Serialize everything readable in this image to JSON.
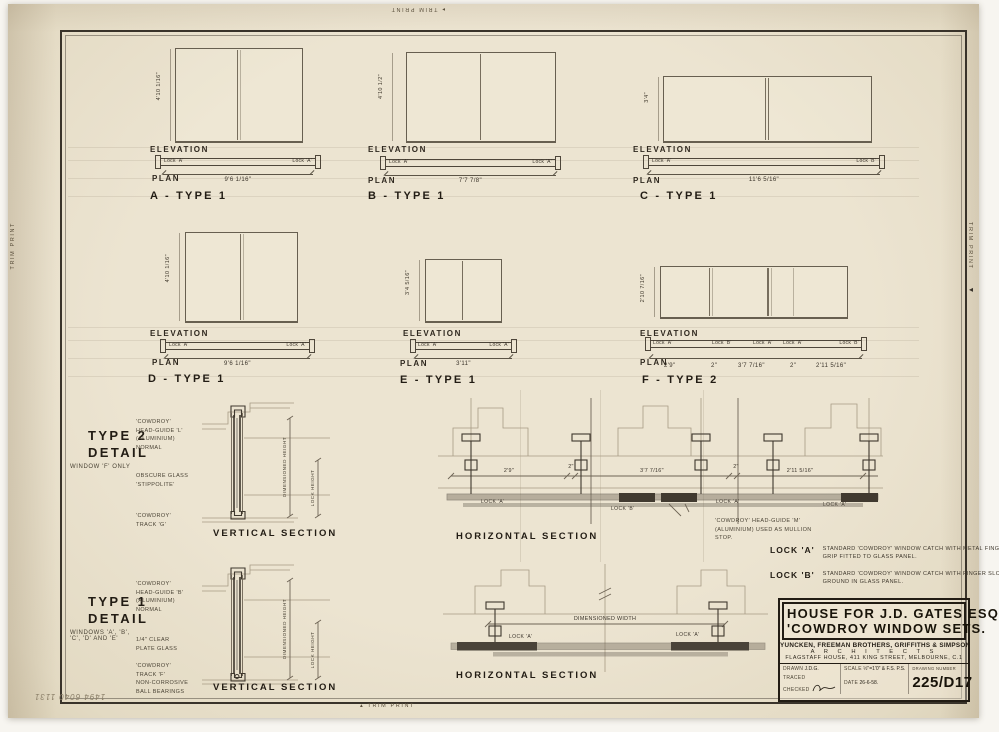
{
  "page": {
    "trim_print": "TRIM PRINT",
    "handwritten_note": "1494 6040 1131"
  },
  "labels": {
    "elevation": "ELEVATION",
    "plan": "PLAN"
  },
  "windows": [
    {
      "letter": "A",
      "title": "A - TYPE 1",
      "height": "4'10 1/16\"",
      "width": "9'6 1/16\"",
      "lock_left": "Lock 'A'",
      "lock_right": "Lock 'A'"
    },
    {
      "letter": "B",
      "title": "B - TYPE 1",
      "height": "4'10 1/2\"",
      "width": "7'7 7/8\"",
      "lock_left": "Lock 'A'",
      "lock_right": "Lock 'A'"
    },
    {
      "letter": "C",
      "title": "C - TYPE 1",
      "height": "3'4\"",
      "width": "11'6 5/16\"",
      "lock_left": "Lock 'A'",
      "lock_right": "Lock 'B'"
    },
    {
      "letter": "D",
      "title": "D - TYPE 1",
      "height": "4'10 1/16\"",
      "width": "9'6 1/16\"",
      "lock_left": "Lock 'A'",
      "lock_right": "Lock 'A'"
    },
    {
      "letter": "E",
      "title": "E - TYPE 1",
      "height": "3'4 5/16\"",
      "width": "3'11\"",
      "lock_left": "Lock 'A'",
      "lock_right": "Lock 'A'"
    },
    {
      "letter": "F",
      "title": "F - TYPE 2",
      "height": "2'10 7/16\"",
      "plan_locks": [
        "Lock 'A'",
        "Lock 'B'",
        "Lock 'A'",
        "Lock 'A'",
        "Lock 'B'"
      ],
      "plan_dims": [
        "2'9\"",
        "2\"",
        "3'7 7/16\"",
        "2\"",
        "2'11 5/16\""
      ]
    }
  ],
  "type2_detail": {
    "heading": "TYPE 2\nDETAIL",
    "subtitle": "WINDOW 'F' ONLY",
    "note_head_guide": "'COWDROY'\nHEAD-GUIDE 'L'\n(ALUMINIUM)\nNORMAL",
    "note_glass": "OBSCURE GLASS\n'STIPPOLITE'",
    "note_track": "'COWDROY'\nTRACK 'G'",
    "dim_height": "DIMENSIONED HEIGHT",
    "dim_lock": "LOCK HEIGHT",
    "caption": "VERTICAL SECTION"
  },
  "type1_detail": {
    "heading": "TYPE 1\nDETAIL",
    "subtitle": "WINDOWS 'A', 'B',\n'C', 'D' AND 'E'",
    "note_head_guide": "'COWDROY'\nHEAD-GUIDE 'B'\n(ALUMINIUM)\nNORMAL",
    "note_glass": "1/4\" CLEAR\nPLATE GLASS",
    "note_track": "'COWDROY'\nTRACK 'F'\nNON-CORROSIVE\nBALL BEARINGS",
    "dim_height": "DIMENSIONED HEIGHT",
    "dim_lock": "LOCK HEIGHT",
    "caption": "VERTICAL SECTION"
  },
  "hsection_top": {
    "caption": "HORIZONTAL SECTION",
    "dims": [
      "2'9\"",
      "2\"",
      "3'7 7/16\"",
      "2\"",
      "2'11 5/16\""
    ],
    "locks": [
      "LOCK 'A'",
      "LOCK 'B'",
      "LOCK 'A'",
      "LOCK 'A'"
    ],
    "note": "'COWDROY' HEAD-GUIDE 'M' (ALUMINIUM) USED AS MULLION STOP."
  },
  "hsection_bottom": {
    "caption": "HORIZONTAL SECTION",
    "width_label": "DIMENSIONED WIDTH",
    "lock_left": "LOCK 'A'",
    "lock_right": "LOCK 'A'"
  },
  "lock_notes": {
    "a_label": "LOCK 'A'",
    "a_text": "STANDARD 'COWDROY' WINDOW CATCH WITH METAL FINGER GRIP FITTED TO GLASS PANEL.",
    "b_label": "LOCK 'B'",
    "b_text": "STANDARD 'COWDROY' WINDOW CATCH WITH FINGER SLOT GROUND IN GLASS PANEL."
  },
  "title_block": {
    "project": "HOUSE FOR J.D. GATES ESQ",
    "subject": "'COWDROY WINDOW SETS.",
    "firm": "YUNCKEN, FREEMAN BROTHERS, GRIFFITHS & SIMPSON",
    "architects": "A R C H I T E C T S",
    "address": "FLAGSTAFF HOUSE, 411 KING STREET, MELBOURNE, C.1",
    "drawn_label": "DRAWN",
    "drawn": "J.D.G.",
    "traced_label": "TRACED",
    "checked_label": "CHECKED",
    "scale_label": "SCALE",
    "scale": "½\"=1'0\" & F.S. P.S.",
    "date_label": "DATE",
    "date": "26-6-58.",
    "number_label": "DRAWING NUMBER",
    "number": "225/D17"
  }
}
